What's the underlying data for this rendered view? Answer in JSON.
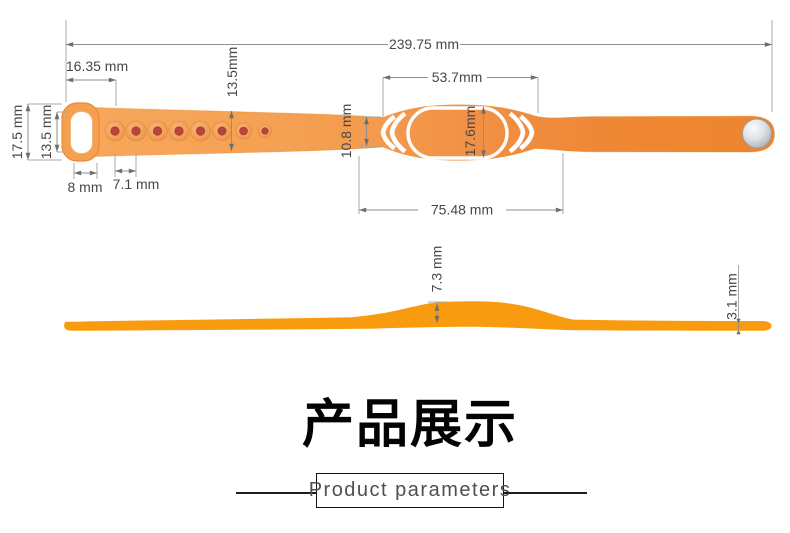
{
  "top_view": {
    "labels": {
      "total_length": "239.75 mm",
      "buckle_offset": "16.35 mm",
      "band_width": "13.5mm",
      "clasp_outer_height": "17.5 mm",
      "clasp_inner_height": "13.5 mm",
      "clasp_width": "8 mm",
      "hole_pitch": "7.1 mm",
      "face_length": "53.7mm",
      "neck_width": "10.8 mm",
      "face_width": "17.6mm",
      "face_span": "75.48 mm"
    }
  },
  "side_view": {
    "labels": {
      "bump_thickness": "7.3 mm",
      "band_thickness": "3.1 mm"
    }
  },
  "footer": {
    "heading": "产品展示",
    "box_label": "Product parameters"
  },
  "colors": {
    "band_orange": "#F49B4A",
    "band_orange_deep": "#EE8430",
    "side_profile_orange": "#F99B0E",
    "hole_dot_red": "#B5463A",
    "metal_silver": "#C7CCD0"
  }
}
